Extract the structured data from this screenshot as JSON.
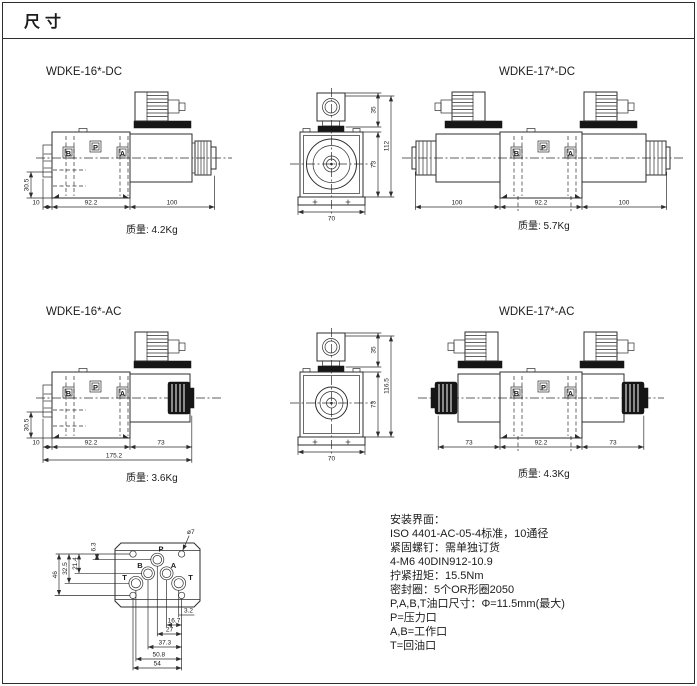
{
  "page": {
    "title": "尺寸"
  },
  "ports": {
    "b": "B",
    "p": "P",
    "a": "A"
  },
  "drawings": {
    "wdke16dc": {
      "label": "WDKE-16*-DC",
      "mass": "质量: 4.2Kg",
      "dims": {
        "offset": "10",
        "body": "92.2",
        "solenoid": "100",
        "height": "30.5"
      }
    },
    "front_dc": {
      "dims": {
        "connector": "35",
        "body": "73",
        "total": "112",
        "width": "70"
      }
    },
    "wdke17dc": {
      "label": "WDKE-17*-DC",
      "mass": "质量: 5.7Kg",
      "dims": {
        "left": "100",
        "body": "92.2",
        "right": "100"
      }
    },
    "wdke16ac": {
      "label": "WDKE-16*-AC",
      "mass": "质量: 3.6Kg",
      "dims": {
        "offset": "10",
        "body": "92.2",
        "solenoid": "73",
        "overall": "175.2",
        "height": "30.5"
      }
    },
    "front_ac": {
      "dims": {
        "connector": "35",
        "body": "73",
        "total": "116.5",
        "width": "70"
      }
    },
    "wdke17ac": {
      "label": "WDKE-17*-AC",
      "mass": "质量: 4.3Kg",
      "dims": {
        "left": "73",
        "body": "92.2",
        "right": "73"
      }
    }
  },
  "mounting": {
    "hole": "ø7",
    "ports": {
      "p": "P",
      "a": "A",
      "b": "B",
      "t1": "T",
      "t2": "T"
    },
    "bottom": [
      "3.2",
      "16.7",
      "27",
      "37.3",
      "50.8",
      "54"
    ],
    "left": [
      "6.3",
      "21.4",
      "32.5",
      "46"
    ]
  },
  "notes": {
    "lines": [
      "安装界面：",
      "ISO 4401-AC-05-4标准，10通径",
      "紧固螺钉：需单独订货",
      "4-M6 40DIN912-10.9",
      "拧紧扭矩：15.5Nm",
      "密封圈：5个OR形圈2050",
      "P,A,B,T油口尺寸：Φ=11.5mm(最大)",
      "P=压力口",
      "A,B=工作口",
      "T=回油口"
    ]
  }
}
